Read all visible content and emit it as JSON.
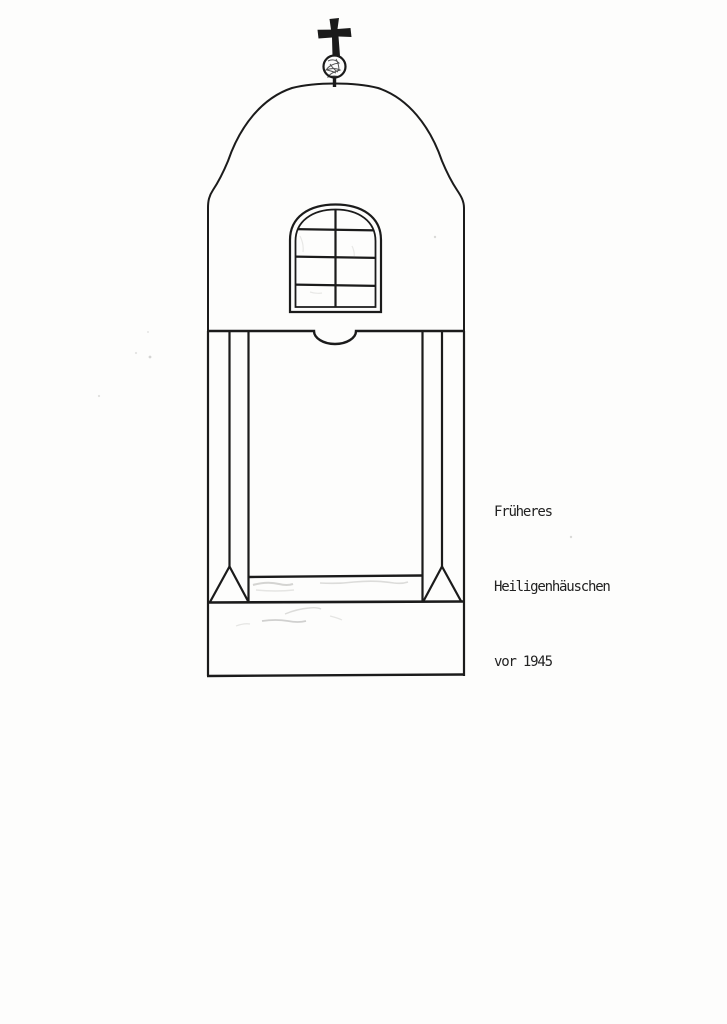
{
  "page": {
    "kind": "scanned archival page with hand-drawn elevation sketch of a wayside shrine"
  },
  "theme": {
    "paper": "#fdfdfc",
    "ink": "#1b1b1b",
    "text": "#222222",
    "smudge": "#6a6a66"
  },
  "caption": {
    "lines": [
      "Früheres",
      "Heiligenhäuschen",
      "vor 1945"
    ]
  },
  "drawing": {
    "subject": "Heiligenhäuschen (small wayside shrine), front elevation",
    "elements": [
      "cross-finial",
      "orb-finial",
      "dome-with-ogee-shoulders",
      "arched-window-with-mullion-and-three-bars",
      "beam-line-with-central-notch",
      "niche-opening-with-corner-posts",
      "triangular-post-feet",
      "niche-sill",
      "pedestal-base"
    ]
  }
}
